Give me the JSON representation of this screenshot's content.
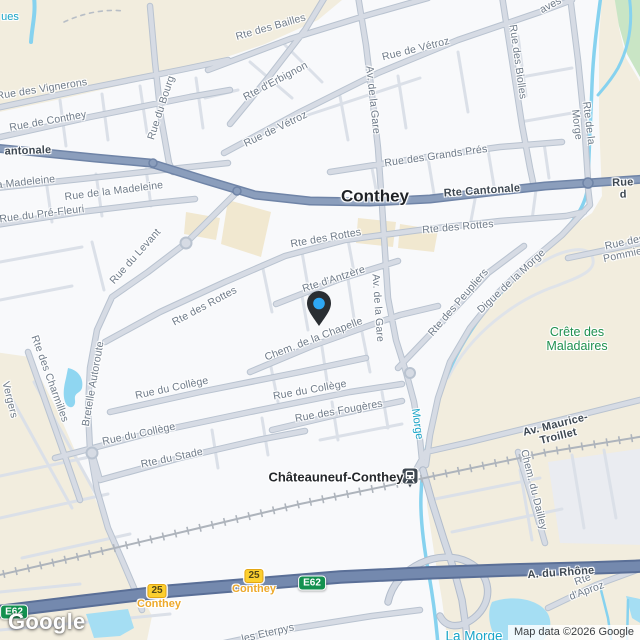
{
  "map": {
    "provider_logo": "Google",
    "attribution": "Map data ©2026 Google",
    "marker": {
      "name": "dropped-pin",
      "pin_color": "#2A2E33",
      "dot_color": "#2EA7F4"
    },
    "station": {
      "name": "Châteauneuf-Conthey",
      "type": "train-station"
    },
    "colors": {
      "land": "#F8F9FB",
      "scrub_beige": "#F2EDDE",
      "park_green": "#C9E5C5",
      "water": "#86D2EF",
      "highway": "#7489AE",
      "major_road": "#8B9EBC",
      "exit_yellow": "#FCCF2F",
      "route_shield_green": "#13914F",
      "nature_label_green": "#1F9150",
      "water_label_teal": "#19A5C8"
    },
    "labels": [
      {
        "text": "ues",
        "x": 10,
        "y": 17,
        "rot": 0,
        "kind": "water"
      },
      {
        "text": "Rte des Bailles",
        "x": 271,
        "y": 28,
        "rot": -16,
        "kind": "street"
      },
      {
        "text": "Rue des Vignerons",
        "x": 42,
        "y": 90,
        "rot": -9,
        "kind": "street"
      },
      {
        "text": "Rue de Conthey",
        "x": 48,
        "y": 122,
        "rot": -10,
        "kind": "street"
      },
      {
        "text": "Rue du Bourg",
        "x": 162,
        "y": 108,
        "rot": -72,
        "kind": "street"
      },
      {
        "text": "Rte d'Erbignon",
        "x": 276,
        "y": 82,
        "rot": -28,
        "kind": "street"
      },
      {
        "text": "Rue de Vétroz",
        "x": 276,
        "y": 130,
        "rot": -26,
        "kind": "street"
      },
      {
        "text": "Rue de Vétroz",
        "x": 416,
        "y": 50,
        "rot": -14,
        "kind": "street"
      },
      {
        "text": "aves",
        "x": 551,
        "y": 6,
        "rot": -28,
        "kind": "street"
      },
      {
        "text": "Av. de la Gare",
        "x": 372,
        "y": 100,
        "rot": 84,
        "kind": "street"
      },
      {
        "text": "Av. de la Gare",
        "x": 377,
        "y": 308,
        "rot": 86,
        "kind": "street"
      },
      {
        "text": "Rue des Biolles",
        "x": 517,
        "y": 62,
        "rot": 82,
        "kind": "street"
      },
      {
        "text": "Rte de la Morge",
        "x": 582,
        "y": 124,
        "rot": 83,
        "kind": "street"
      },
      {
        "text": "Rue des Grands Prés",
        "x": 436,
        "y": 157,
        "rot": -8,
        "kind": "street"
      },
      {
        "text": "Rue de la Madeleine",
        "x": 114,
        "y": 192,
        "rot": -7,
        "kind": "street"
      },
      {
        "text": "a Madeleine",
        "x": 26,
        "y": 183,
        "rot": -6,
        "kind": "street"
      },
      {
        "text": "Rue du Pré-Fleuri",
        "x": 42,
        "y": 215,
        "rot": -7,
        "kind": "street"
      },
      {
        "text": "Rue du Levant",
        "x": 136,
        "y": 257,
        "rot": -48,
        "kind": "street"
      },
      {
        "text": "Rte des Rottes",
        "x": 205,
        "y": 307,
        "rot": -28,
        "kind": "street"
      },
      {
        "text": "Rte des Rottes",
        "x": 326,
        "y": 239,
        "rot": -10,
        "kind": "street"
      },
      {
        "text": "Rte des Rottes",
        "x": 458,
        "y": 228,
        "rot": -5,
        "kind": "street"
      },
      {
        "text": "Rte d'Antzère",
        "x": 334,
        "y": 280,
        "rot": -18,
        "kind": "street"
      },
      {
        "text": "Chem. de la Chapelle",
        "x": 314,
        "y": 340,
        "rot": -21,
        "kind": "street"
      },
      {
        "text": "Rue du Collège",
        "x": 172,
        "y": 389,
        "rot": -12,
        "kind": "street"
      },
      {
        "text": "Rue du Collège",
        "x": 310,
        "y": 391,
        "rot": -10,
        "kind": "street"
      },
      {
        "text": "Rue du Collège",
        "x": 139,
        "y": 435,
        "rot": -12,
        "kind": "street"
      },
      {
        "text": "Rue des Fougères",
        "x": 339,
        "y": 412,
        "rot": -10,
        "kind": "street"
      },
      {
        "text": "Rte du Stade",
        "x": 172,
        "y": 459,
        "rot": -12,
        "kind": "street"
      },
      {
        "text": "Rte des Charmilles",
        "x": 49,
        "y": 379,
        "rot": 70,
        "kind": "street"
      },
      {
        "text": "Bretelle Autoroute",
        "x": 94,
        "y": 384,
        "rot": -80,
        "kind": "street"
      },
      {
        "text": "Vergers",
        "x": 9,
        "y": 400,
        "rot": 76,
        "kind": "street"
      },
      {
        "text": "Rue des Pommiers",
        "x": 626,
        "y": 249,
        "rot": -12,
        "kind": "street"
      },
      {
        "text": "Rte des Peupliers",
        "x": 459,
        "y": 303,
        "rot": -49,
        "kind": "street"
      },
      {
        "text": "Digue de la Morge",
        "x": 512,
        "y": 282,
        "rot": -43,
        "kind": "street"
      },
      {
        "text": "Crête des\nMaladaires",
        "x": 577,
        "y": 339,
        "rot": 0,
        "kind": "nature"
      },
      {
        "text": "Av. Maurice-Troillet",
        "x": 557,
        "y": 431,
        "rot": -14,
        "kind": "road"
      },
      {
        "text": "Chem. du Dailley",
        "x": 533,
        "y": 490,
        "rot": 76,
        "kind": "street"
      },
      {
        "text": "Châteauneuf-Conthey",
        "x": 336,
        "y": 478,
        "rot": 0,
        "kind": "locality"
      },
      {
        "text": "Conthey",
        "x": 375,
        "y": 196,
        "rot": 0,
        "kind": "town"
      },
      {
        "text": "Rte Cantonale",
        "x": 482,
        "y": 191,
        "rot": -4,
        "kind": "road"
      },
      {
        "text": "antonale",
        "x": 28,
        "y": 151,
        "rot": -2,
        "kind": "road"
      },
      {
        "text": "Rue d",
        "x": 623,
        "y": 189,
        "rot": -2,
        "kind": "road"
      },
      {
        "text": "A. du Rhône",
        "x": 561,
        "y": 573,
        "rot": -4,
        "kind": "road"
      },
      {
        "text": "Rte d'Aproz",
        "x": 585,
        "y": 586,
        "rot": -20,
        "kind": "street"
      },
      {
        "text": "les Eterpys",
        "x": 268,
        "y": 634,
        "rot": -13,
        "kind": "street"
      },
      {
        "text": "Morge",
        "x": 417,
        "y": 424,
        "rot": 82,
        "kind": "water"
      },
      {
        "text": "La Morge",
        "x": 474,
        "y": 636,
        "rot": 0,
        "kind": "water_big"
      }
    ],
    "exits": [
      {
        "number": "25",
        "name": "Conthey",
        "bx": 157,
        "by": 591,
        "nx": 159,
        "ny": 604
      },
      {
        "number": "25",
        "name": "Conthey",
        "bx": 254,
        "by": 576,
        "nx": 254,
        "ny": 589
      }
    ],
    "shields": [
      {
        "text": "E62",
        "x": 14,
        "y": 612
      },
      {
        "text": "E62",
        "x": 312,
        "y": 583
      }
    ]
  }
}
